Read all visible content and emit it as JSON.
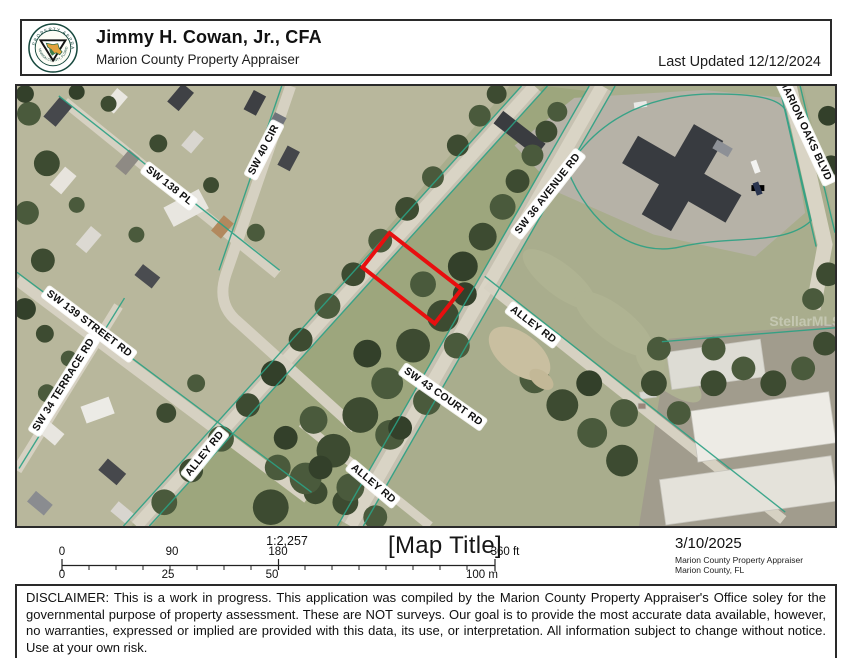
{
  "header": {
    "name": "Jimmy H. Cowan, Jr., CFA",
    "title": "Marion County Property Appraiser",
    "last_updated": "Last Updated 12/12/2024",
    "logo_text_top": "PROPERTY APPRAISER",
    "logo_text_bottom": "MARION COUNTY, FLORIDA"
  },
  "map": {
    "road_labels": [
      {
        "text": "SW 40 CIR"
      },
      {
        "text": "SW 138 PL"
      },
      {
        "text": "SW 139 STREET RD"
      },
      {
        "text": "SW 34 TERRACE RD"
      },
      {
        "text": "SW 36 AVENUE RD"
      },
      {
        "text": "MARION OAKS BLVD"
      },
      {
        "text": "ALLEY RD"
      },
      {
        "text": "SW 43 COURT RD"
      },
      {
        "text": "ALLEY RD"
      },
      {
        "text": "ALLEY RD"
      }
    ],
    "watermark": "StellarMLS",
    "parcel_outline_color": "#e80f0f",
    "boundary_line_color": "#2ba184"
  },
  "footer": {
    "scale_bar": {
      "ratio": "1:2,257",
      "feet_labels": [
        "0",
        "90",
        "180",
        "360 ft"
      ],
      "meter_labels": [
        "0",
        "25",
        "50",
        "100 m"
      ]
    },
    "map_title": "[Map Title]",
    "date": "3/10/2025",
    "agency": "Marion County Property Appraiser",
    "region": "Marion County, FL"
  },
  "disclaimer": "DISCLAIMER: This is a work in progress. This application was compiled by the Marion County Property Appraiser's Office soley for the governmental purpose of property assessment. These are NOT surveys. Our goal is to provide the most accurate data available, however, no warranties, expressed or implied are provided with this data, its use, or interpretation. All information subject to change without notice. Use at your own risk."
}
